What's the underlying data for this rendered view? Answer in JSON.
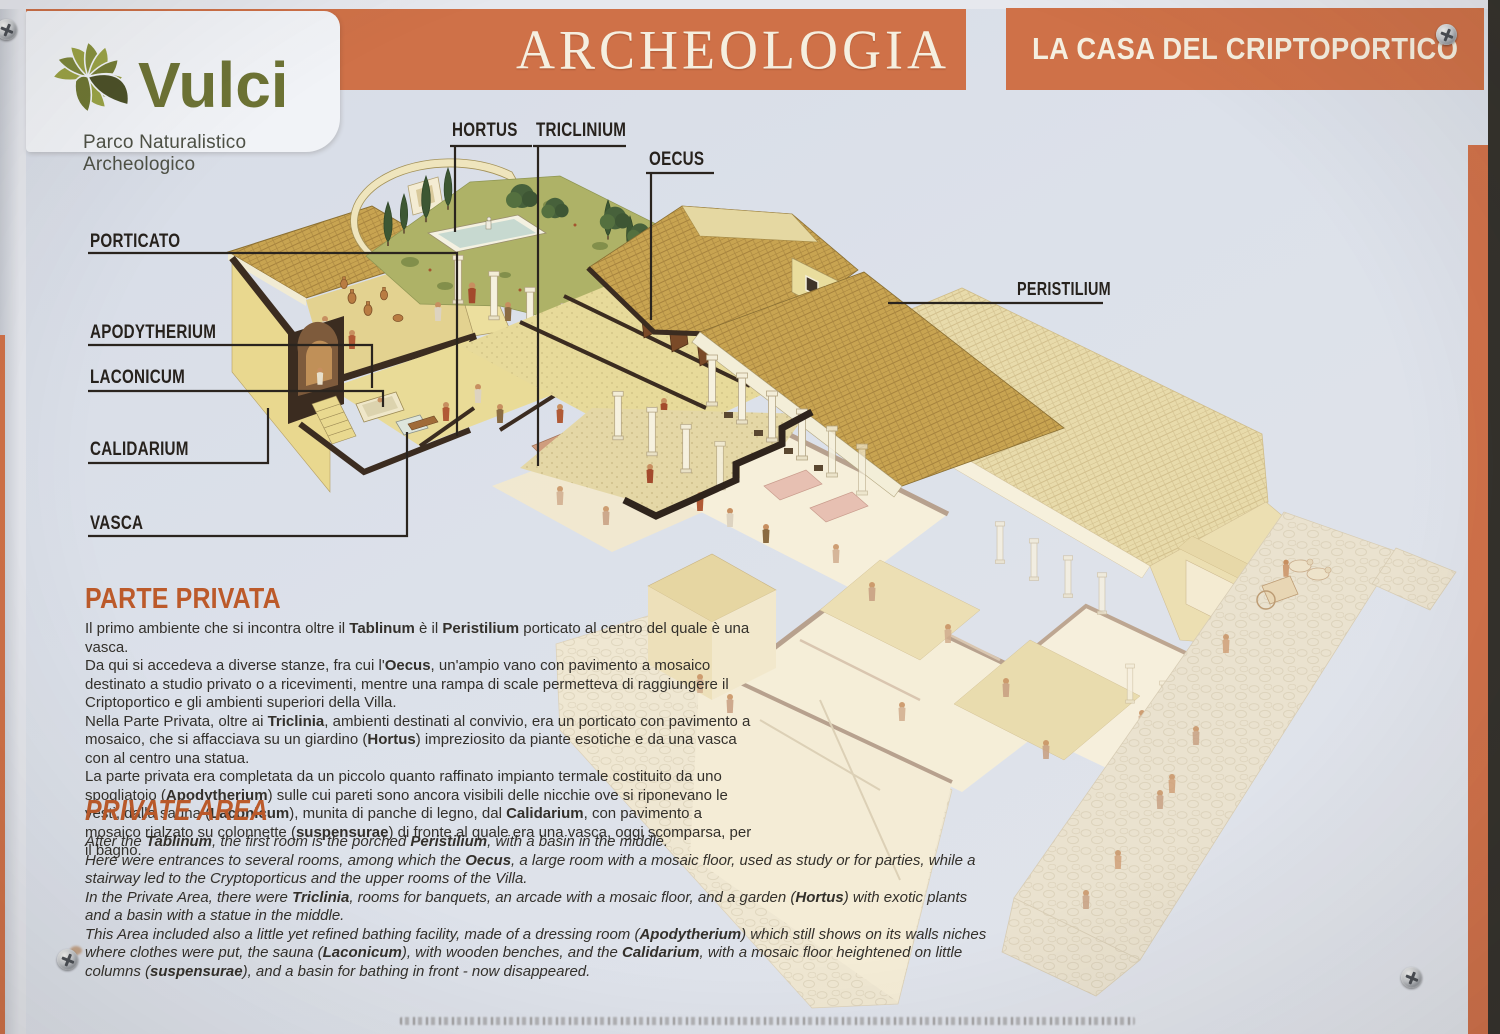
{
  "colors": {
    "band_orange": "#cf7148",
    "heading_orange": "#bc5a2a",
    "panel_background": "#dce1ea",
    "label_ink": "#27221d",
    "roof_tan": "#c8a451",
    "lawn_green": "#aeb267",
    "logo_olive": "#6d7335"
  },
  "logo": {
    "name": "Vulci",
    "tagline": "Parco Naturalistico Archeologico"
  },
  "header": {
    "section_title": "ARCHEOLOGIA",
    "panel_title": "LA CASA DEL CRIPTOPORTICO"
  },
  "diagram": {
    "labels": [
      {
        "id": "porticato",
        "text": "PORTICATO"
      },
      {
        "id": "apodytherium",
        "text": "APODYTHERIUM"
      },
      {
        "id": "laconicum",
        "text": "LACONICUM"
      },
      {
        "id": "calidarium",
        "text": "CALIDARIUM"
      },
      {
        "id": "vasca",
        "text": "VASCA"
      },
      {
        "id": "hortus",
        "text": "HORTUS"
      },
      {
        "id": "triclinium",
        "text": "TRICLINIUM"
      },
      {
        "id": "oecus",
        "text": "OECUS"
      },
      {
        "id": "peristilium",
        "text": "PERISTILIUM"
      }
    ]
  },
  "italian": {
    "heading": "PARTE PRIVATA",
    "paragraphs": [
      [
        {
          "t": "Il primo ambiente che si incontra oltre il "
        },
        {
          "t": "Tablinum",
          "b": true
        },
        {
          "t": " è il "
        },
        {
          "t": "Peristilium",
          "b": true
        },
        {
          "t": " porticato al centro del quale è una vasca."
        }
      ],
      [
        {
          "t": "Da qui si accedeva a diverse stanze, fra cui l'"
        },
        {
          "t": "Oecus",
          "b": true
        },
        {
          "t": ", un'ampio vano con pavimento a mosaico destinato a studio privato o a ricevimenti, mentre una rampa di scale permetteva di raggiungere il Criptoportico e gli ambienti superiori della Villa."
        }
      ],
      [
        {
          "t": "Nella Parte Privata, oltre ai "
        },
        {
          "t": "Triclinia",
          "b": true
        },
        {
          "t": ", ambienti destinati al convivio, era un porticato con pavimento a mosaico, che si affacciava su un giardino ("
        },
        {
          "t": "Hortus",
          "b": true
        },
        {
          "t": ") impreziosito da piante esotiche e da una vasca con al centro una statua."
        }
      ],
      [
        {
          "t": "La parte privata era completata da un piccolo quanto raffinato impianto termale costituito da uno spogliatoio ("
        },
        {
          "t": "Apodytherium",
          "b": true
        },
        {
          "t": ") sulle cui pareti sono ancora visibili delle nicchie ove si riponevano le vesti, dalla sauna ("
        },
        {
          "t": "Laconicum",
          "b": true
        },
        {
          "t": "), munita di panche di legno, dal "
        },
        {
          "t": "Calidarium",
          "b": true
        },
        {
          "t": ", con pavimento a mosaico rialzato su colonnette ("
        },
        {
          "t": "suspensurae",
          "b": true
        },
        {
          "t": ") di fronte al quale era una vasca, oggi scomparsa, per il bagno."
        }
      ]
    ]
  },
  "english": {
    "heading": "PRIVATE AREA",
    "paragraphs": [
      [
        {
          "t": "After the "
        },
        {
          "t": "Tablinum",
          "b": true
        },
        {
          "t": ", the first room is the porched "
        },
        {
          "t": "Peristilium",
          "b": true
        },
        {
          "t": ", with a basin in the middle."
        }
      ],
      [
        {
          "t": "Here were entrances to several rooms, among which the "
        },
        {
          "t": "Oecus",
          "b": true
        },
        {
          "t": ", a large room with a mosaic floor, used as study or for parties, while a stairway led to the Cryptoporticus and the upper rooms of the Villa."
        }
      ],
      [
        {
          "t": "In the Private Area, there were "
        },
        {
          "t": "Triclinia",
          "b": true
        },
        {
          "t": ", rooms for banquets, an arcade with a mosaic floor, and a garden ("
        },
        {
          "t": "Hortus",
          "b": true
        },
        {
          "t": ") with exotic plants and a basin with a statue in the middle."
        }
      ],
      [
        {
          "t": "This Area included also a little yet refined bathing facility, made of a dressing room ("
        },
        {
          "t": "Apodytherium",
          "b": true
        },
        {
          "t": ") which still shows on its walls niches where clothes were put, the sauna ("
        },
        {
          "t": "Laconicum",
          "b": true
        },
        {
          "t": "), with wooden benches, and the "
        },
        {
          "t": "Calidarium",
          "b": true
        },
        {
          "t": ", with a mosaic floor heightened on little columns ("
        },
        {
          "t": "suspensurae",
          "b": true
        },
        {
          "t": "), and a basin for bathing in front - now disappeared."
        }
      ]
    ]
  }
}
